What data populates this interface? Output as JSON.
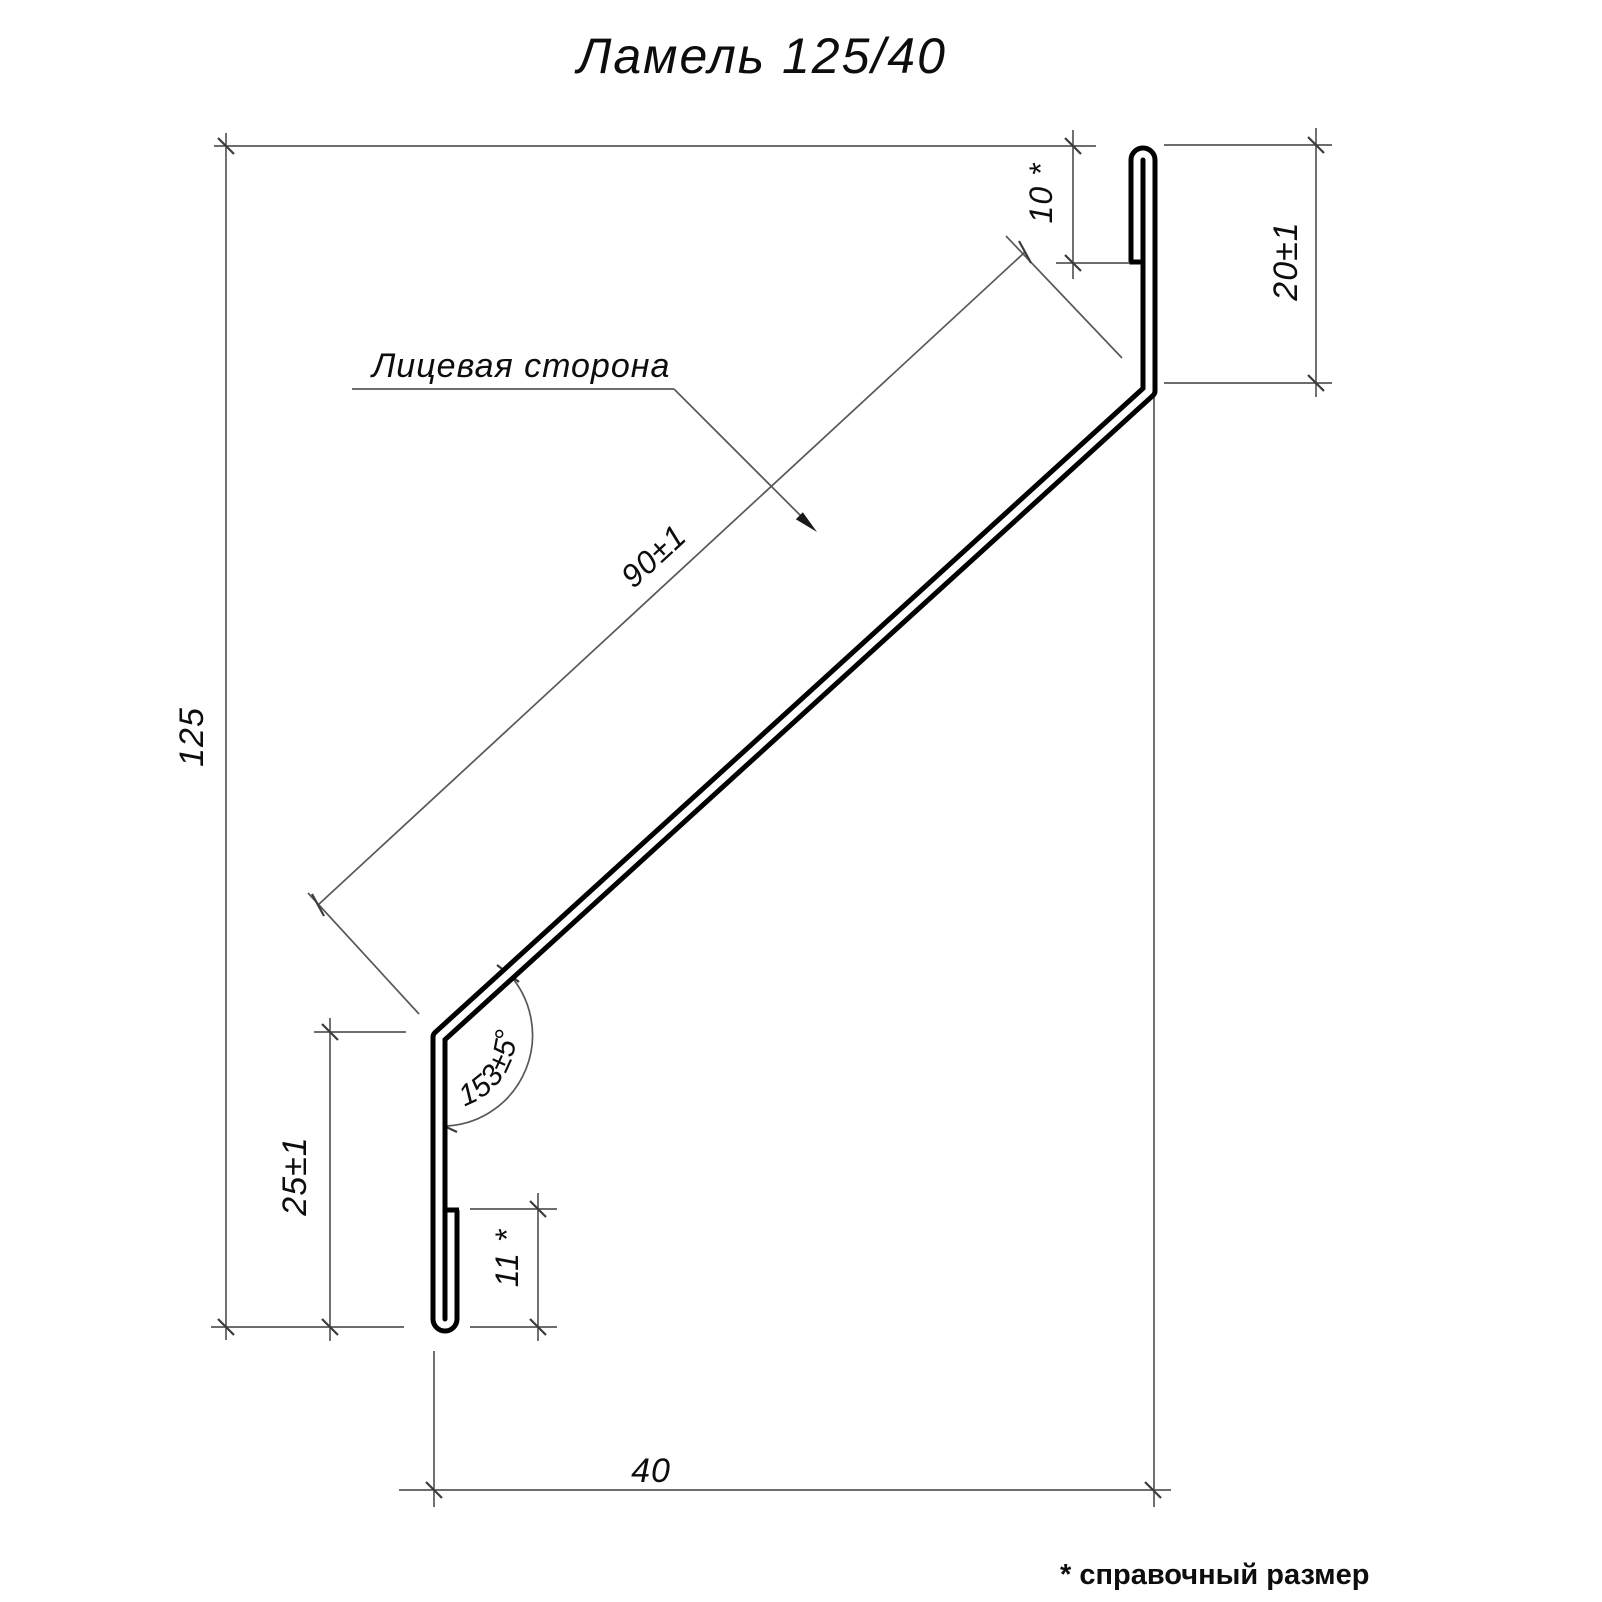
{
  "title": "Ламель 125/40",
  "face_label": "Лицевая сторона",
  "footnote": "* справочный размер",
  "dimensions": {
    "overall_height": "125",
    "face_length": "90±1",
    "top_hem": "10 *",
    "top_return": "20±1",
    "bend_angle": "153±5°",
    "bottom_leg": "25±1",
    "bottom_hem": "11 *",
    "overall_depth": "40"
  },
  "colors": {
    "background": "#ffffff",
    "profile_line": "#000000",
    "dimension_line": "#585858",
    "text": "#0d0d0d"
  }
}
